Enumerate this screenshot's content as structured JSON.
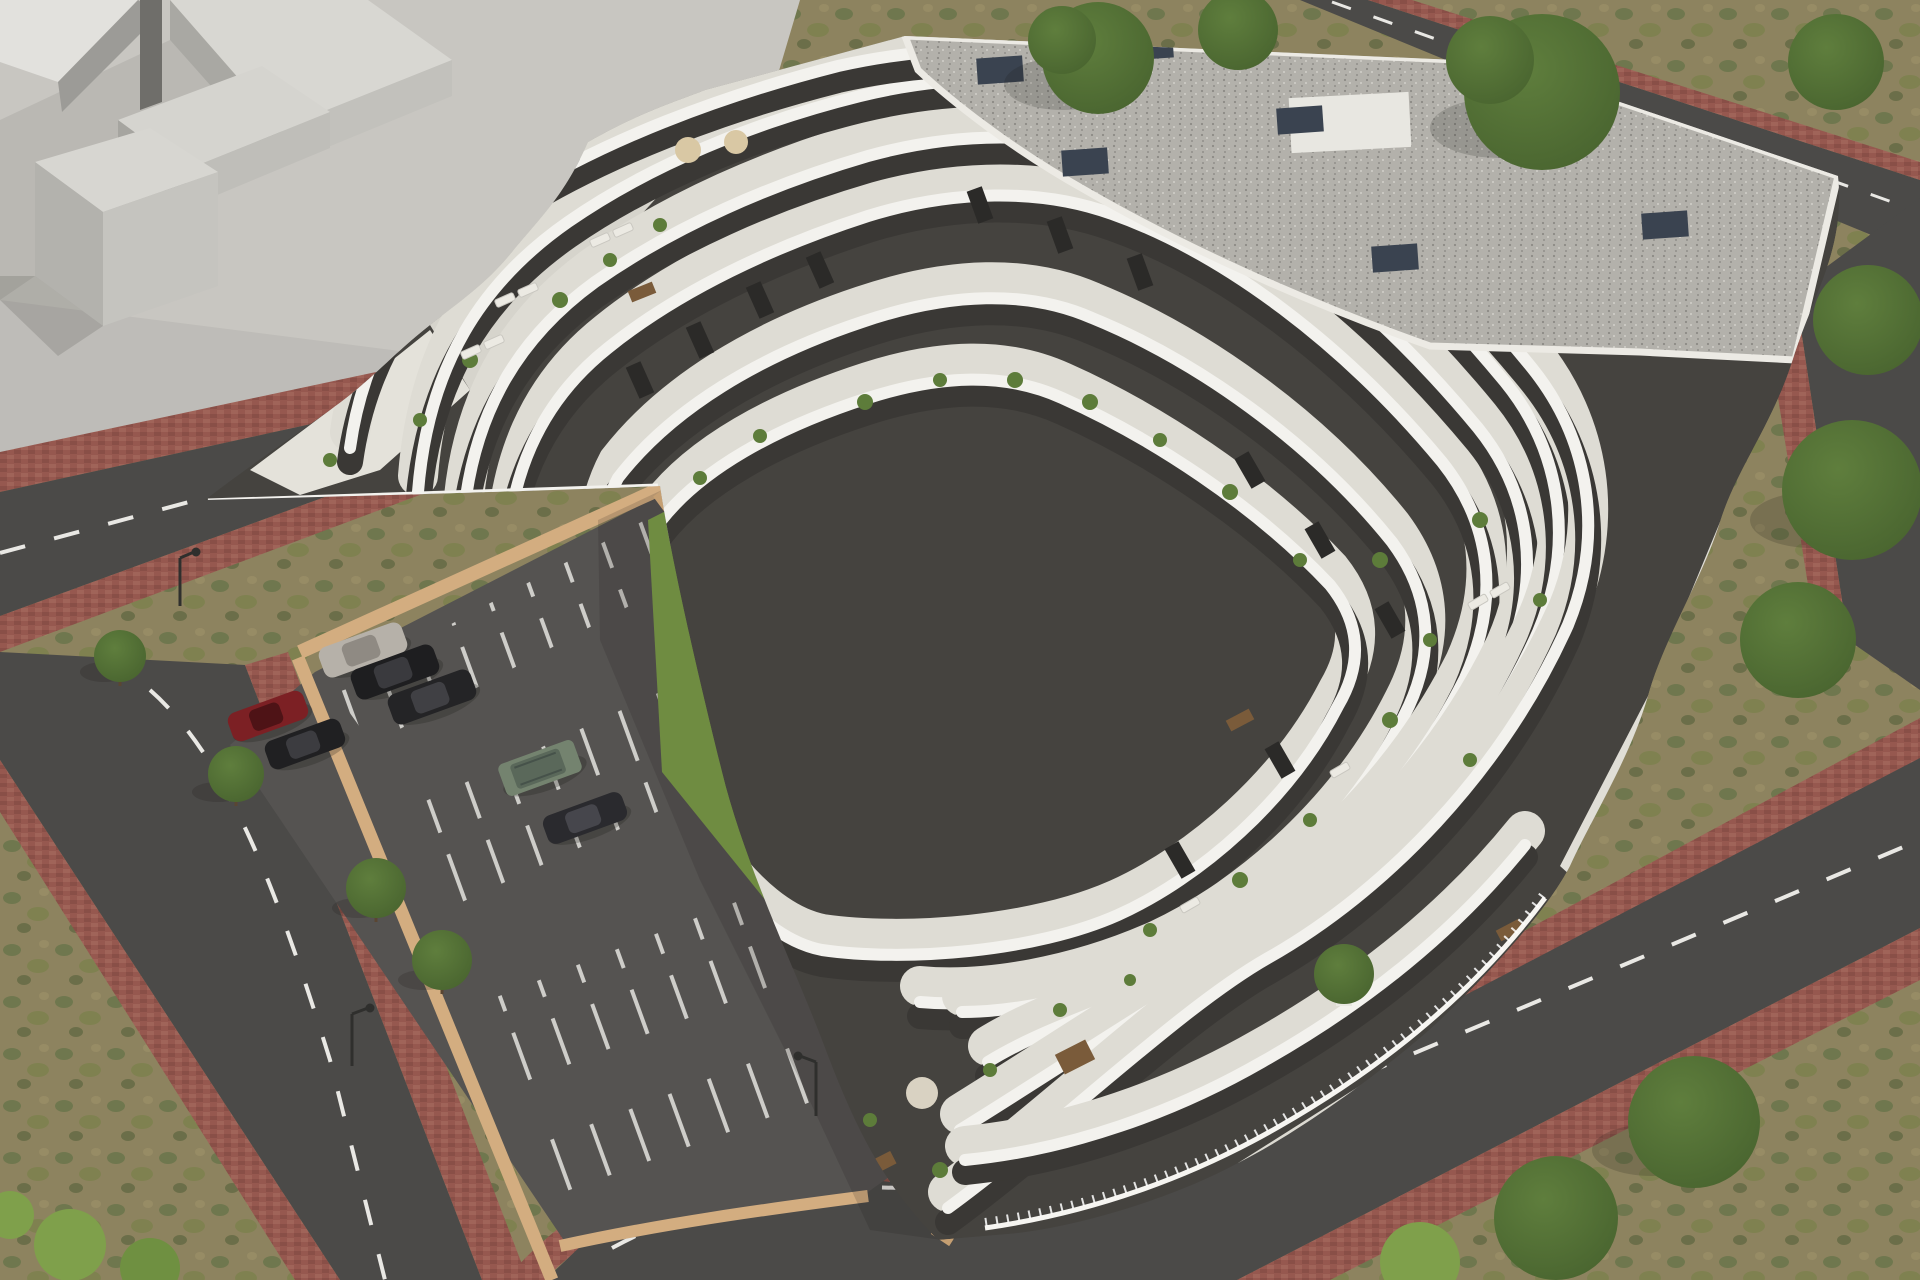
{
  "scene": {
    "type": "aerial-architectural-render",
    "subject": "terraced white apartment complex with curved balconies around a courtyard with lawn, freeform pool, playground, sunken parking lot, perimeter roads and scrubland"
  },
  "palette": {
    "scrub": "#8d835f",
    "scrub_green": "#68744a",
    "scrub_green2": "#79814a",
    "plaza": "#c8c6c1",
    "massing_top": "#d8d7d2",
    "massing_face_light": "#c2c1bc",
    "massing_face_dark": "#a9a8a3",
    "massing_slab_dark": "#6f6e6a",
    "road": "#4b4a48",
    "road_line": "#e9e8e4",
    "brick": "#96584f",
    "brick_dark": "#7d463f",
    "wall_tan": "#d3ad80",
    "podium_tan": "#c59f72",
    "parking": "#555351",
    "stall_line": "#d9d8d3",
    "bldg_white": "#f3f2ee",
    "terrace": "#dedcd4",
    "charcoal": "#45433f",
    "facade_dark": "#3a3835",
    "glass": "#2b2a28",
    "gravel": "#b3b1ab",
    "gravel_dot": "#8c8a85",
    "chimney": "#3a4350",
    "lawn": "#6f8c41",
    "lawn_light": "#7fa04b",
    "pool_light": "#d2eee9",
    "pool_deep": "#9fd4cc",
    "coping": "#f0efe8",
    "deck": "#8f927f",
    "deck_slat": "#7f8270",
    "umbrella": "#d9c8a4",
    "lounger": "#eceae3",
    "plant": "#5d7c3a",
    "tree": "#5f7e3d",
    "tree_dark": "#47622e",
    "play_blue": "#3c6cd4",
    "play_red": "#c0504a",
    "lamp": "#2f2f2d",
    "rug": "#d9d2c2",
    "wood": "#7a5b3a"
  },
  "objects": {
    "cars": [
      {
        "name": "silver-car",
        "color": "#b6b1a9"
      },
      {
        "name": "black-car-1",
        "color": "#1e1e20"
      },
      {
        "name": "black-car-2",
        "color": "#242426"
      },
      {
        "name": "red-car",
        "color": "#7c2024"
      },
      {
        "name": "black-car-3",
        "color": "#202022"
      },
      {
        "name": "green-suv",
        "color": "#74836f"
      },
      {
        "name": "dark-car",
        "color": "#2a2a2e"
      }
    ],
    "pool_umbrellas": 4,
    "folded_parasols": 5,
    "pool_loungers": 10,
    "street_lamps": 3,
    "roof": "flat gravel roof with slate chimney vents",
    "building_floors_visible": 7
  }
}
